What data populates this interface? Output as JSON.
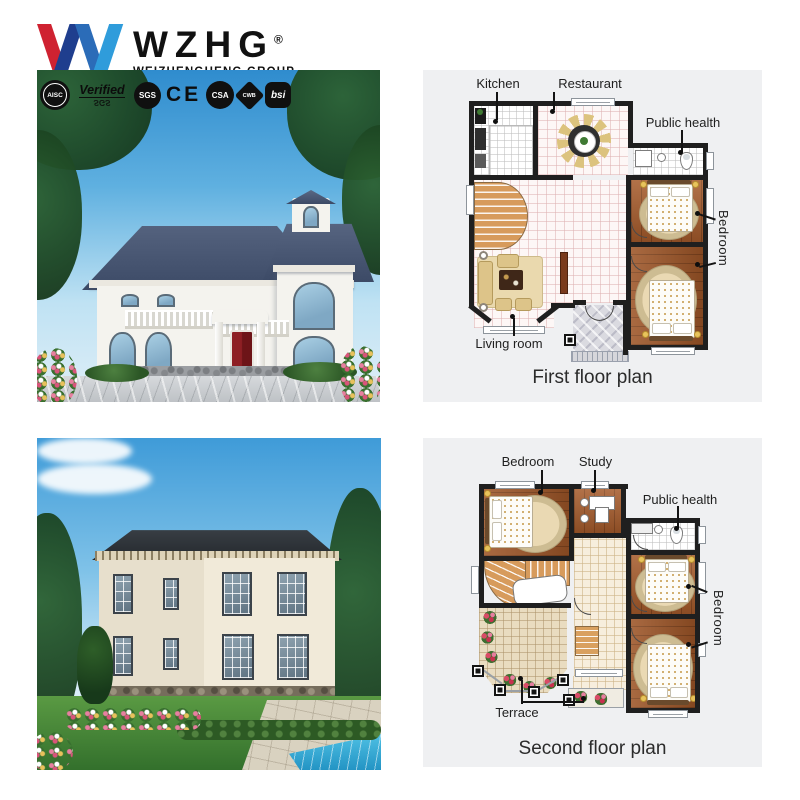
{
  "brand": {
    "name": "WZHG",
    "registered": "®",
    "subtitle": "WEIZHENGHENG GROUP"
  },
  "certifications": {
    "aisc": "AISC",
    "verified": "Verified",
    "verified_sub": "SGS",
    "sgs": "SGS",
    "ce": "CE",
    "csa": "CSA",
    "cwb": "CWB",
    "bsi": "bsi"
  },
  "plans": [
    {
      "caption": "First floor plan",
      "labels": {
        "kitchen": "Kitchen",
        "restaurant": "Restaurant",
        "public_health": "Public health",
        "bedroom": "Bedroom",
        "living_room": "Living room"
      }
    },
    {
      "caption": "Second floor plan",
      "labels": {
        "bedroom_top": "Bedroom",
        "study": "Study",
        "public_health": "Public health",
        "bedroom_right": "Bedroom",
        "terrace": "Terrace"
      }
    }
  ],
  "colors": {
    "logo_red": "#cf2231",
    "logo_navy": "#1f3e8e",
    "logo_blue": "#2f9cdb",
    "plan_background": "#eff0f2",
    "wall": "#1f1f1f",
    "wood_floor": "#a65b2b",
    "door_red": "#8e1f24",
    "sky_blue": "#3f96d4",
    "pool_aqua": "#35b0d8"
  }
}
